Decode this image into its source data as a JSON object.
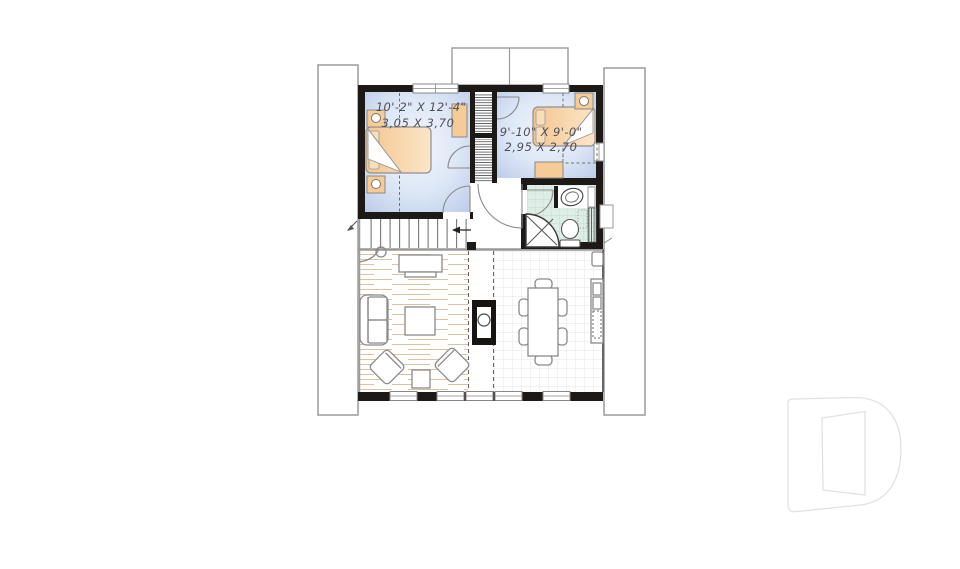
{
  "floorplan": {
    "type": "second-floor-plan",
    "rooms": [
      {
        "name": "bedroom-1",
        "dim_imperial": "10'-2\" X 12'-4\"",
        "dim_metric": "3,05 X 3,70"
      },
      {
        "name": "bedroom-2",
        "dim_imperial": "9'-10\" X 9'-0\"",
        "dim_metric": "2,95 X 2,70"
      }
    ],
    "features": [
      "bed",
      "nightstand",
      "wardrobe",
      "dresser",
      "closet",
      "staircase",
      "down-arrow",
      "bathroom",
      "corner-shower",
      "toilet",
      "sink",
      "linen-storage",
      "wood-stove",
      "sofa",
      "armchair",
      "coffee-table",
      "tv-cabinet",
      "side-table",
      "dining-table",
      "dining-chair",
      "kitchen-counter",
      "dormer",
      "roof-outline",
      "open-to-below"
    ],
    "colors": {
      "wall": "#1d1916",
      "bedroom_floor": "#bfcde9",
      "bedroom_floor_light": "#f1f5fc",
      "furniture_orange": "#f5cb97",
      "furniture_orange_light": "#fbe6c9",
      "bathroom_tile": "#ddeee6",
      "bathroom_tile_line": "#b8d6c6",
      "outline_gray": "#8a8a8a",
      "wood_plank": "#dcc2a2",
      "dining_tile_line": "#e3e3e3",
      "label_text": "#4e4e58",
      "logo_outline": "#e2e2e2"
    },
    "logo": {
      "name": "drummond-d-logo"
    }
  }
}
